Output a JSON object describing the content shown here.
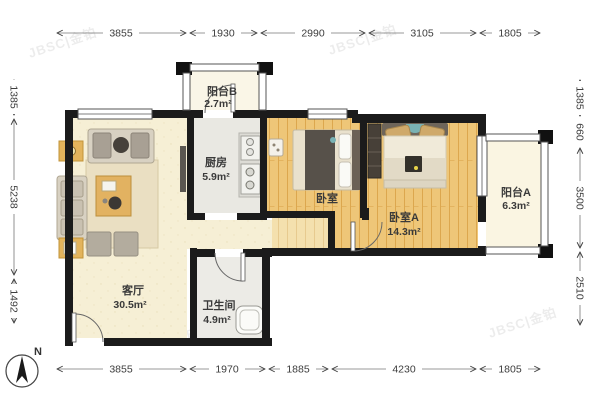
{
  "rooms": {
    "balcony_b": {
      "name": "阳台B",
      "area": "2.7m²"
    },
    "kitchen": {
      "name": "厨房",
      "area": "5.9m²"
    },
    "bedroom": {
      "name": "卧室"
    },
    "bedroom_a": {
      "name": "卧室A",
      "area": "14.3m²"
    },
    "balcony_a": {
      "name": "阳台A",
      "area": "6.3m²"
    },
    "living": {
      "name": "客厅",
      "area": "30.5m²"
    },
    "bath": {
      "name": "卫生间",
      "area": "4.9m²"
    }
  },
  "dimensions": {
    "top": [
      "3855",
      "1930",
      "2990",
      "3105",
      "1805"
    ],
    "bottom": [
      "3855",
      "1970",
      "1885",
      "4230",
      "1805"
    ],
    "left": [
      "1385",
      "5238",
      "1492"
    ],
    "right": [
      "1385",
      "660",
      "3500",
      "2510"
    ]
  },
  "compass": {
    "label": "N"
  },
  "watermark": {
    "text": "JBSC|金铂"
  },
  "colors": {
    "wall": "#1b1b1b",
    "wood_floor": "#eec678",
    "living_floor": "#f6efd5",
    "kitchen_floor": "#e9e8e2",
    "balcony_floor": "#faf6e7",
    "accent_teal": "#79b2b4",
    "table_wood": "#e2b261"
  }
}
